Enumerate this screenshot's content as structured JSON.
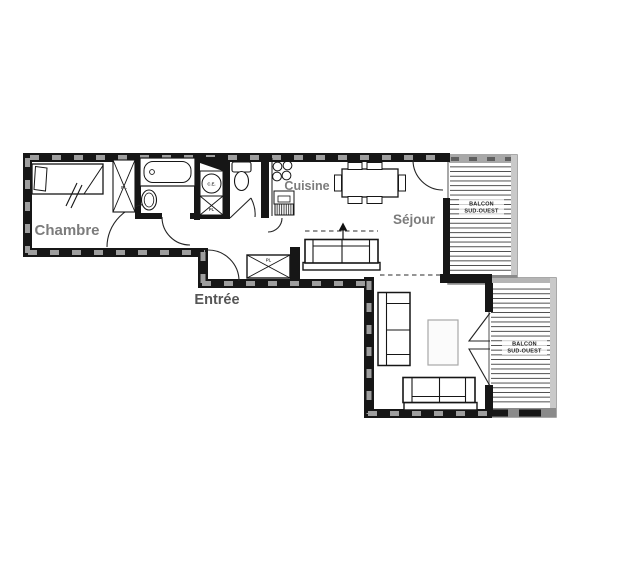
{
  "plan": {
    "background": "#ffffff",
    "colors": {
      "wall": "#161616",
      "wall_hatch": "#9e9e9e",
      "balcony_frame": "#8c8c8c",
      "balcony_deck_line": "#3c3c3c",
      "room_label_gray": "#7c7c7c",
      "entree_label_gray": "#565656",
      "small_label_gray": "#3f3f3f",
      "coffee_table_border": "#a8a8a8"
    },
    "rooms": {
      "chambre": {
        "label": "Chambre"
      },
      "cuisine": {
        "label": "Cuisine"
      },
      "sejour": {
        "label": "Séjour"
      },
      "entree": {
        "label": "Entrée"
      }
    },
    "balconies": {
      "balcon1": {
        "line1": "BALCON",
        "line2": "SUD-OUEST"
      },
      "balcon2": {
        "line1": "BALCON",
        "line2": "SUD-OUEST"
      }
    },
    "closets": {
      "chambre_closet": "PL",
      "hall_closet": "PL",
      "entree_closet": "PL"
    },
    "equipment": {
      "water_heater": "C.E."
    }
  }
}
